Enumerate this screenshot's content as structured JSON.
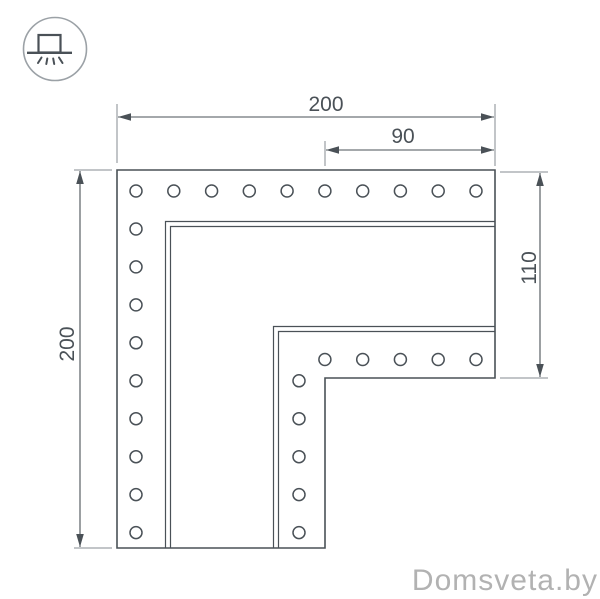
{
  "watermark": {
    "text": "Domsveta.by",
    "color": "#b2b2b2"
  },
  "icons": {
    "top_left": "recessed-light-icon"
  },
  "drawing": {
    "line_color": "#4a5157",
    "extension_color": "#858b90",
    "dimensions": {
      "top": "200",
      "inner_top": "90",
      "left": "200",
      "right": "110"
    },
    "holes": {
      "radius": 6,
      "rows": [
        {
          "name": "outer-top-row",
          "cy": 191,
          "cx": [
            136,
            173.8,
            211.6,
            249.3,
            287.1,
            324.9,
            362.7,
            400.4,
            438.2,
            476
          ]
        },
        {
          "name": "outer-left-column",
          "cx": 136,
          "cy": [
            229,
            266.9,
            304.9,
            342.8,
            380.8,
            418.7,
            456.7,
            494.6,
            532.6
          ]
        },
        {
          "name": "inner-top-row",
          "cy": 359.5,
          "cx": [
            324.9,
            362.7,
            400.4,
            438.2,
            476
          ]
        },
        {
          "name": "inner-left-column",
          "cx": 299,
          "cy": [
            380.8,
            418.7,
            456.7,
            494.6,
            532.6
          ]
        }
      ]
    }
  }
}
